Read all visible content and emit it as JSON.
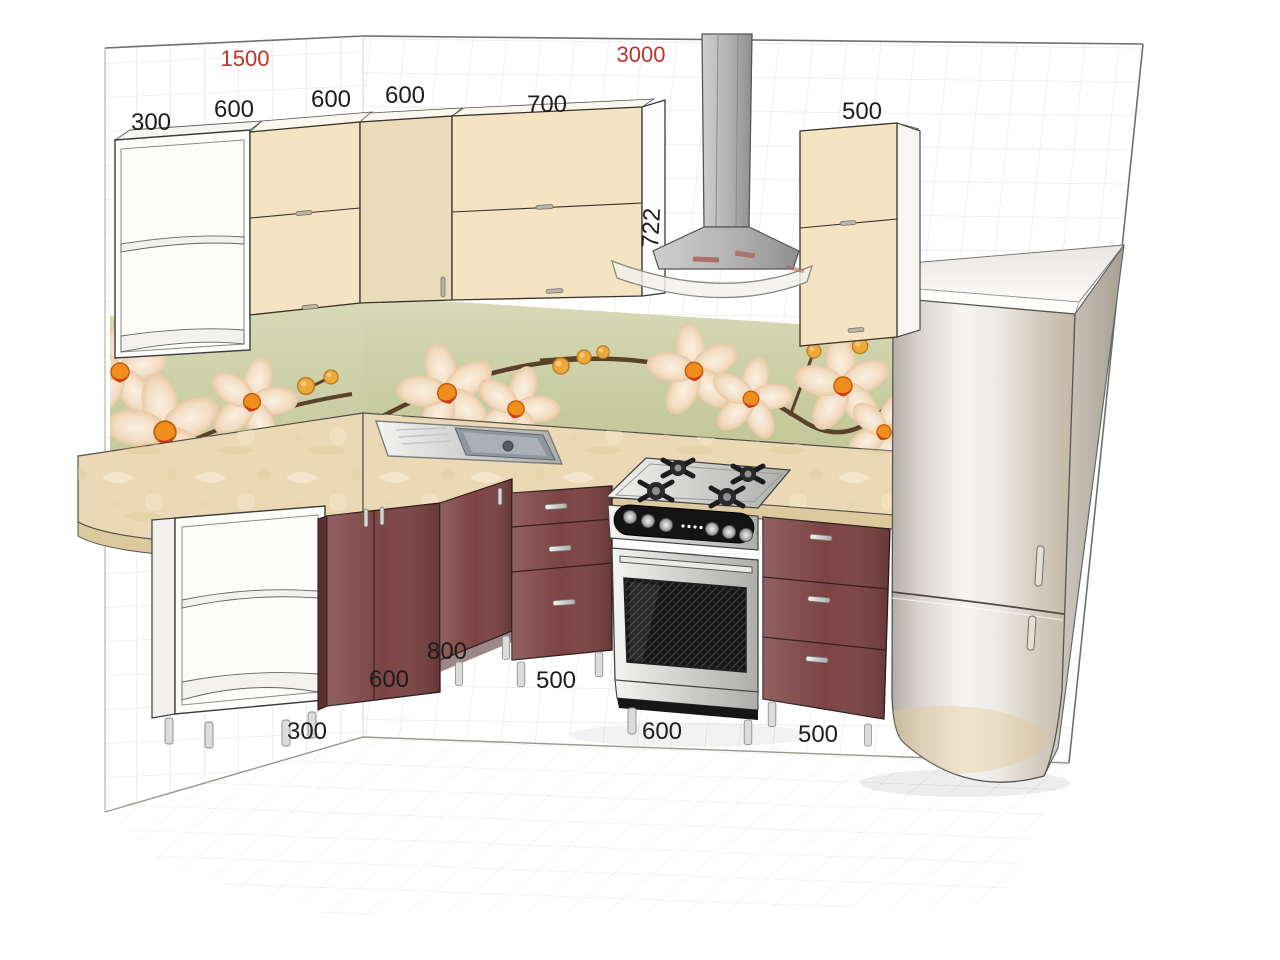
{
  "dimensions": {
    "wall_left_total": "1500",
    "wall_right_total": "3000",
    "upper_row": [
      "300",
      "600",
      "600",
      "600",
      "700",
      "500"
    ],
    "upper_cabinet_height": "722",
    "lower_row": [
      "800",
      "600",
      "500",
      "300",
      "600",
      "500"
    ]
  },
  "colors": {
    "dimension_text": "#1d1d1d",
    "dimension_text_red": "#c0332b",
    "cabinet_cream": "#f4e4c1",
    "cabinet_burgundy": "#7c4343",
    "cabinet_burgundy_dark": "#5d3030",
    "backsplash_green": "#cdd1a3",
    "countertop_beige": "#ead9b4",
    "counter_edge": "#dcc99e",
    "hood_gray": "#b5b5b5",
    "shelf_unit_white": "#fcfcfa"
  }
}
